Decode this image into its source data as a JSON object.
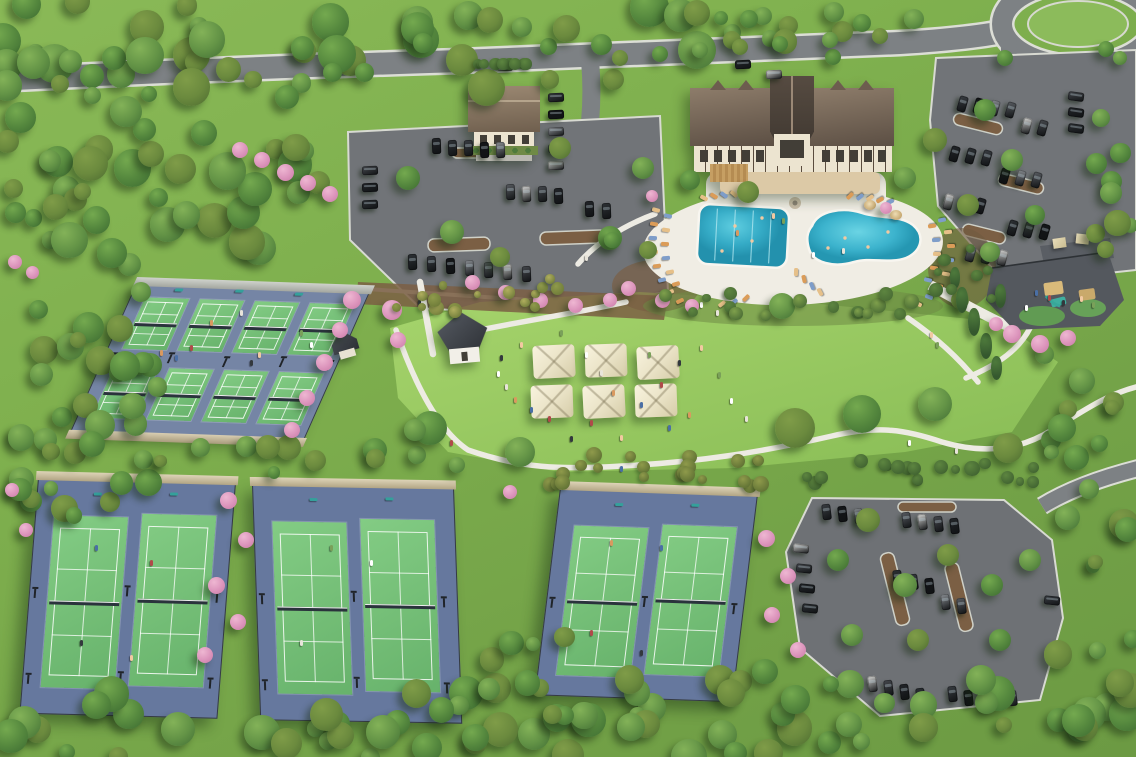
{
  "scene": {
    "description": "Aerial rendering of a community amenity campus: Tudor-style clubhouse with two-lobe resort pool and sun deck, event lawn with shade tents and cottage, eight pickleball courts, six tennis courts in three fenced enclosures, playground, winding walking paths, roundabout entry road and three tree-lined parking lots surrounded by forest with pink flowering trees",
    "counts": {
      "pickleball_courts": 8,
      "tennis_courts": 6,
      "event_tents": 6,
      "pools": 2,
      "parking_lots": 3,
      "buildings": 4
    },
    "palette": {
      "grass_base": "#7cae4d",
      "lawn_bright": "#9ccb63",
      "lawn_deep": "#82b552",
      "tree_dark": "#3c6a31",
      "tree_mid": "#55883e",
      "tree_light": "#74a94f",
      "tree_olive": "#7f9c48",
      "conifer_dark": "#35582e",
      "conifer_light": "#4e7a3c",
      "pink_deep": "#c97aa6",
      "pink_mid": "#dd96bd",
      "pink_light": "#eeb7d2",
      "bush_olive": "#8f9a4b",
      "bush_yellow": "#b0ae5e",
      "bush_green": "#5d8540",
      "road_asphalt": "#7d8184",
      "road_curb": "#dcded6",
      "parking_asphalt": "#717478",
      "path_white": "#edebe3",
      "court_blue_tennis": "#66789e",
      "court_blue_pickle": "#7585a5",
      "court_green": "#74c178",
      "court_line": "#ffffff",
      "wall_tan": "#d3c8ac",
      "wall_gray": "#bcc0bb",
      "fence_dark": "#353b42",
      "pool_teal": "#2fa6c2",
      "pool_teal_light": "#53c5d9",
      "deck_white": "#f0ede4",
      "chair_tan": "#e6c089",
      "chair_orange": "#db9c58",
      "chair_blue": "#7e9dc9",
      "roof_dark": "#3a332d",
      "roof_brown": "#6e5e4f",
      "roof_taupe": "#8d7c6a",
      "roof_slate": "#3a3f46",
      "wall_cream": "#ece4d0",
      "timber": "#5a4c3e",
      "tent_cream": "#eee7cc",
      "playground_surface": "#54585e",
      "mound_green": "#619b53",
      "mulch_brown": "#7b5f44",
      "car_colors": [
        "#23262a",
        "#2e3236",
        "#3a3e43",
        "#15171a",
        "#8d9196",
        "#5a5e63",
        "#d8d8d6",
        "#46494e"
      ],
      "people_colors": [
        "#ffffff",
        "#e8e4da",
        "#d9995f",
        "#4a6fa5",
        "#b04a4a",
        "#33383d",
        "#f2c9a1",
        "#7aa05a"
      ]
    }
  }
}
